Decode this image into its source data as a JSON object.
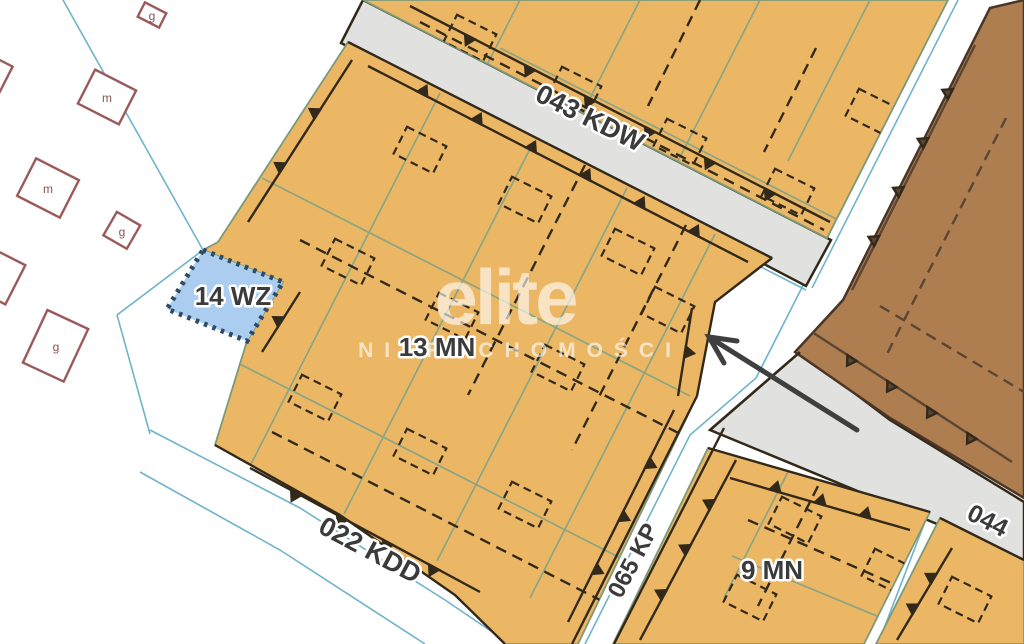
{
  "title": "zoning-plan-map",
  "watermark": {
    "brand": "elite",
    "subtitle": "NIERUCHOMOŚCI"
  },
  "zones": {
    "mn13": "13 MN",
    "mn9": "9 MN",
    "wz14": "14 WZ"
  },
  "roads": {
    "kdw043": "043 KDW",
    "kdd022": "022 KDD",
    "kp065": "065 KP",
    "r044": "044"
  },
  "buildings": [
    {
      "label": "g"
    },
    {
      "label": "m"
    },
    {
      "label": "m"
    },
    {
      "label": "g"
    },
    {
      "label": "g"
    }
  ],
  "colors": {
    "background": "#ffffff",
    "residential_fill": "#ecb765",
    "services_fill": "#ae7e51",
    "water_zone_fill": "#abcdf0",
    "water_zone_border": "#2d4a66",
    "road_fill": "#e1e1e0",
    "cadastral_line": "#6fb3cc",
    "parcel_line": "#8ba584",
    "zone_edge": "#7d9a78",
    "dark_line": "#33291a",
    "label_text": "#3b3b3b",
    "building_outline": "#9b5a5a",
    "building_letter": "#8a5252",
    "arrow": "#3f3f3f",
    "watermark_text": "rgba(255,255,255,0.62)"
  }
}
